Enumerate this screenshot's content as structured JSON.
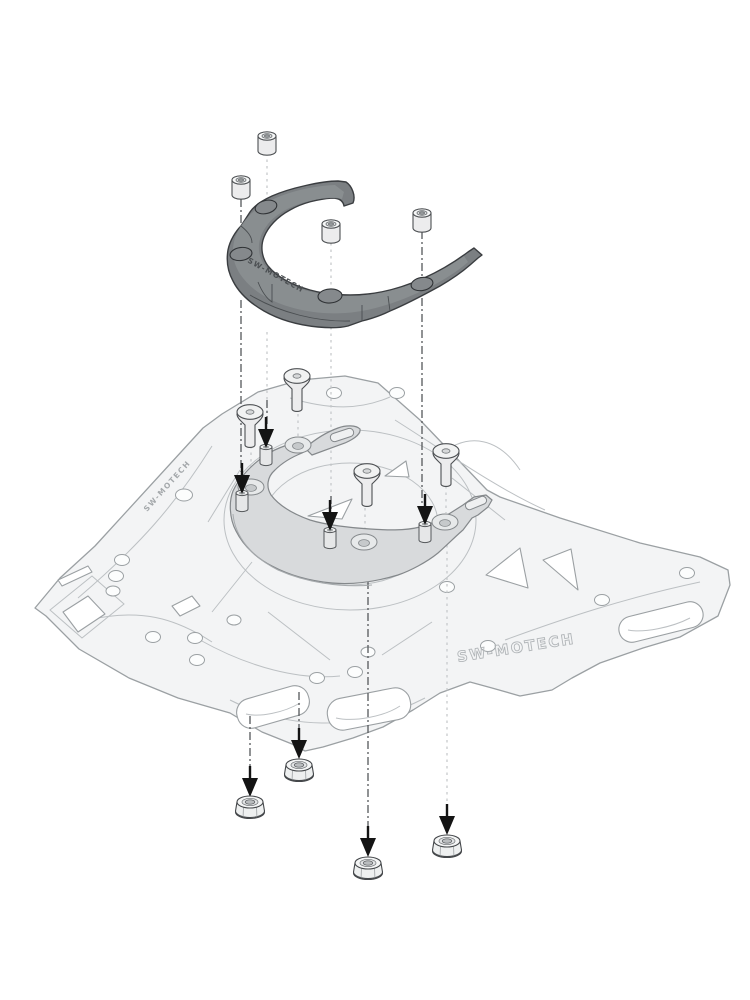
{
  "figure": {
    "kind": "exploded assembly diagram",
    "subject": "tank-ring adapter kit mounted on luggage rack plate",
    "background_color": "#ffffff"
  },
  "engravings": {
    "tank_ring": "SW-MOTECH",
    "rack_edge": "SW-MOTECH",
    "rack_surface": "SW-MOTECH"
  },
  "parts": {
    "tank_ring": {
      "label": "tank ring (upper dark part)",
      "color": "#7b7f82",
      "outline": "#3a3d40",
      "holes": 4
    },
    "spacers": {
      "label": "cylindrical spacers",
      "count": 4,
      "color": "#ececed"
    },
    "flathead_screws": {
      "label": "countersunk screws",
      "count": 4,
      "color": "#ececed"
    },
    "adapter_ring": {
      "label": "adapter ring on rack",
      "color": "#d8dadc",
      "outline": "#84888b",
      "countersunk_holes": 4,
      "slot_holes": 2
    },
    "standoff_pins": {
      "label": "threaded standoff pins",
      "count": 4,
      "color": "#e6e7e8"
    },
    "luggage_rack": {
      "label": "luggage rack plate",
      "color": "#f3f4f5",
      "outline": "#9ba0a3"
    },
    "flange_nuts": {
      "label": "hex flange nuts",
      "count": 4,
      "color": "#eef0f0"
    }
  },
  "annotations": {
    "arrow_markers": {
      "count": 8,
      "color": "#141414"
    },
    "leader_lines": {
      "style": "dash-dot",
      "dark_color": "#55585b",
      "light_color": "#c3c6c8"
    }
  }
}
